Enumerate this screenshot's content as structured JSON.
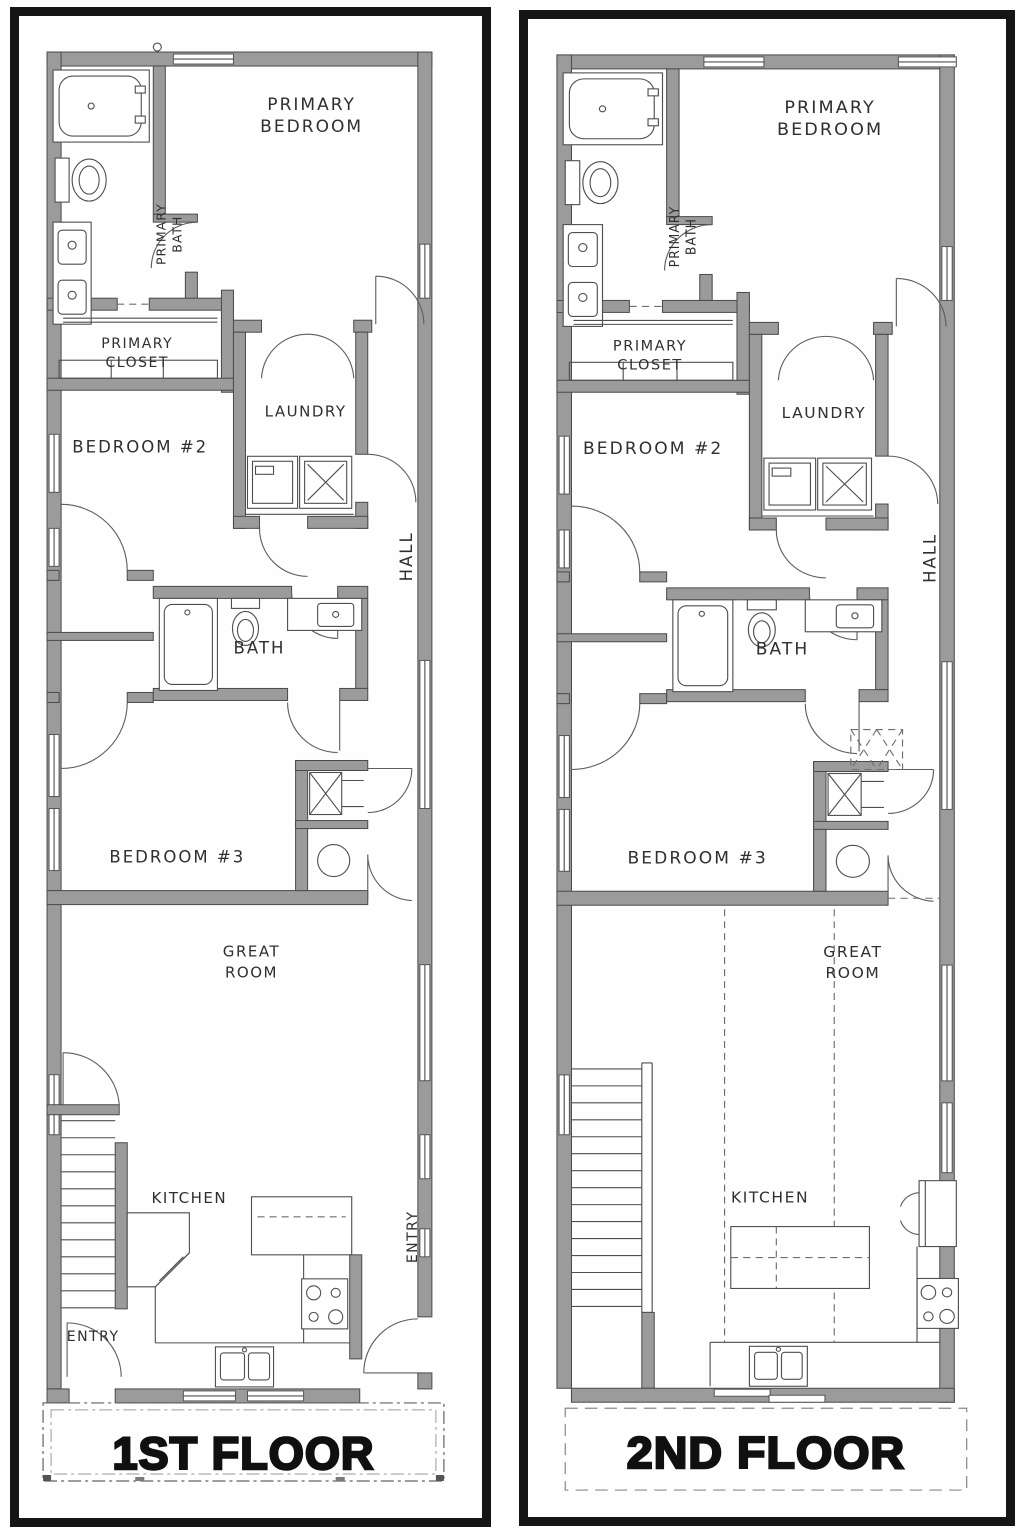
{
  "colors": {
    "frame": "#151515",
    "wall_fill": "#9b9b9b",
    "wall_outline": "#4a4a4a",
    "line": "#4f4f4f",
    "text": "#2f2f2f",
    "title": "#101010",
    "bg": "#ffffff"
  },
  "floor1": {
    "title": "1ST FLOOR",
    "rooms": {
      "primary_bedroom_1": "PRIMARY",
      "primary_bedroom_2": "BEDROOM",
      "primary_bath_1": "PRIMARY",
      "primary_bath_2": "BATH",
      "primary_closet_1": "PRIMARY",
      "primary_closet_2": "CLOSET",
      "laundry": "LAUNDRY",
      "bedroom2": "BEDROOM #2",
      "hall": "HALL",
      "bath": "BATH",
      "bedroom3": "BEDROOM #3",
      "great_room_1": "GREAT",
      "great_room_2": "ROOM",
      "kitchen": "KITCHEN",
      "entry_front": "ENTRY",
      "entry_side": "ENTRY"
    }
  },
  "floor2": {
    "title": "2ND FLOOR",
    "rooms": {
      "primary_bedroom_1": "PRIMARY",
      "primary_bedroom_2": "BEDROOM",
      "primary_bath_1": "PRIMARY",
      "primary_bath_2": "BATH",
      "primary_closet_1": "PRIMARY",
      "primary_closet_2": "CLOSET",
      "laundry": "LAUNDRY",
      "bedroom2": "BEDROOM #2",
      "hall": "HALL",
      "bath": "BATH",
      "bedroom3": "BEDROOM #3",
      "great_room_1": "GREAT",
      "great_room_2": "ROOM",
      "kitchen": "KITCHEN"
    }
  }
}
